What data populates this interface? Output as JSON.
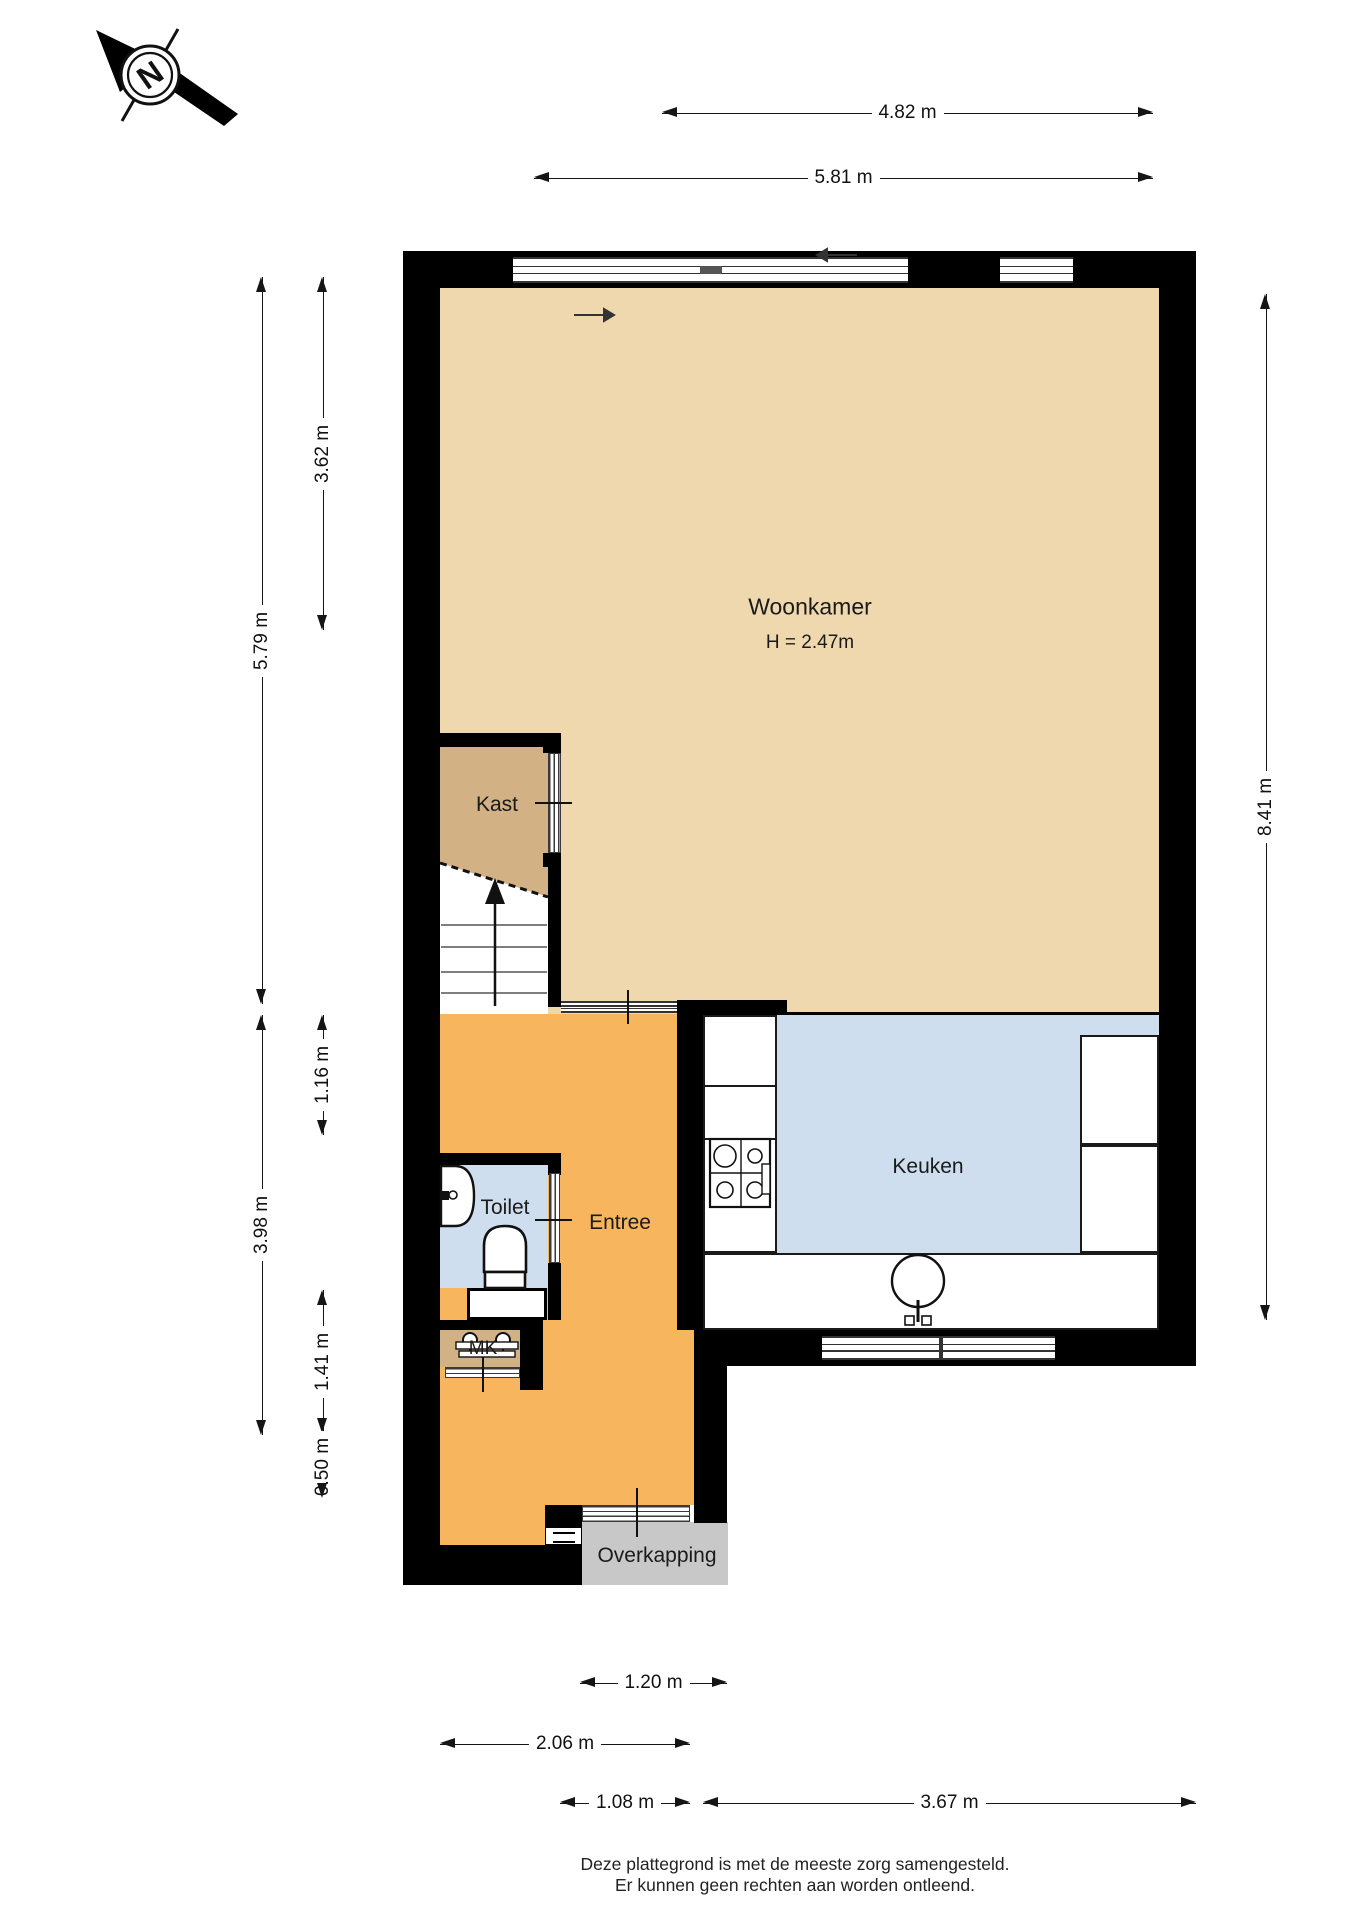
{
  "compass": {
    "label": "N"
  },
  "rooms": {
    "woonkamer": {
      "label": "Woonkamer",
      "ceiling_height": "H = 2.47m"
    },
    "kast": {
      "label": "Kast"
    },
    "toilet": {
      "label": "Toilet"
    },
    "entree": {
      "label": "Entree"
    },
    "keuken": {
      "label": "Keuken"
    },
    "mk": {
      "label": "MK"
    },
    "overkapping": {
      "label": "Overkapping"
    }
  },
  "dimensions": {
    "top": [
      {
        "label": "4.82 m"
      },
      {
        "label": "5.81 m"
      }
    ],
    "left": [
      {
        "label": "3.62 m"
      },
      {
        "label": "5.79 m"
      },
      {
        "label": "1.16 m"
      },
      {
        "label": "3.98 m"
      },
      {
        "label": "1.41 m"
      },
      {
        "label": "0.50 m"
      }
    ],
    "right": [
      {
        "label": "8.41 m"
      }
    ],
    "bottom": [
      {
        "label": "1.20 m"
      },
      {
        "label": "2.06 m"
      },
      {
        "label": "1.08 m"
      },
      {
        "label": "3.67 m"
      }
    ]
  },
  "footer": {
    "line1": "Deze plattegrond is met de meeste zorg samengesteld.",
    "line2": "Er kunnen geen rechten aan worden ontleend."
  },
  "colors": {
    "wall": "#000000",
    "woonkamer_floor": "#f0d8ae",
    "kast_floor": "#d2b184",
    "entree_floor": "#f7b55e",
    "keuken_floor": "#cfdeee",
    "toilet_floor": "#cfdeee",
    "overkapping_floor": "#c8c8c8",
    "dimension_line": "#151515"
  }
}
